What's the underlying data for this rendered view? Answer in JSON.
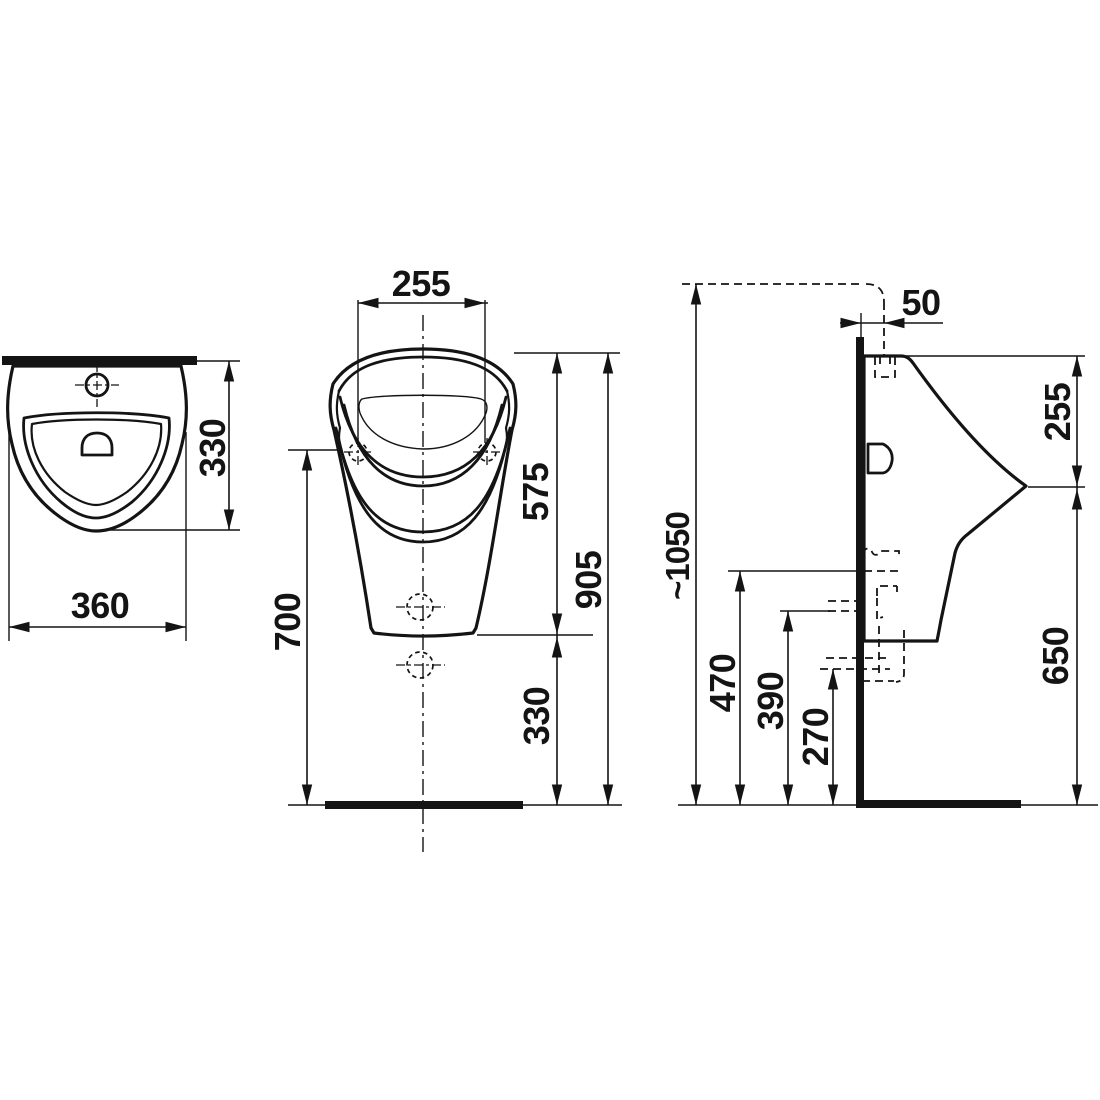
{
  "page": {
    "type": "technical dimension drawing — wall-hung urinal, three orthographic views",
    "background": "#ffffff",
    "line_color": "#141414"
  },
  "dimensions": {
    "top_view": {
      "width": "360",
      "depth": "330"
    },
    "front_view": {
      "fixing_hole_spacing": "255",
      "rim_to_lip": "575",
      "rim_to_floor": "905",
      "fixing_hole_height": "700",
      "lip_to_floor": "330"
    },
    "side_view": {
      "supply_offset": "50",
      "rim_to_spout": "255",
      "supply_height": "~1050",
      "spout_to_floor": "650",
      "level_470": "470",
      "level_390": "390",
      "level_270": "270"
    }
  }
}
